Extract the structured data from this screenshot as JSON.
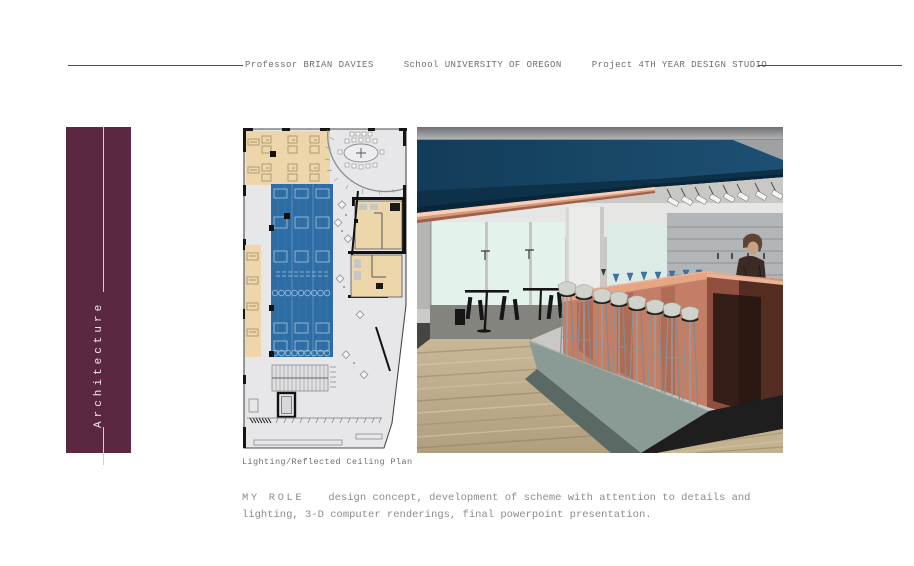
{
  "header": {
    "items": [
      "Professor BRIAN DAVIES",
      "School UNIVERSITY OF OREGON",
      "Project 4TH YEAR DESIGN STUDIO"
    ]
  },
  "sidebar": {
    "label": "Architecture"
  },
  "figures": {
    "plan": {
      "caption": "Lighting/Reflected Ceiling Plan"
    }
  },
  "role": {
    "label": "MY ROLE",
    "line1": "design concept, development of scheme with attention to details and",
    "line2": "lighting, 3-D computer renderings, final powerpoint presentation."
  },
  "colors": {
    "accent": "#5b2741",
    "rule": "#6b4152",
    "header_text": "#6e6e6e",
    "caption_text": "#6e6e6e",
    "body_text": "#8c8c8c",
    "plan_blue": "#2e6da4",
    "plan_tan": "#edd6aa",
    "plan_bg": "#e7e7e9",
    "ceiling_blue": "#123c59",
    "bar_copper": "#c47e66",
    "window_pale": "#e3f2eb",
    "platform_green": "#8a9a94",
    "wood_floor": "#bcab8b"
  }
}
